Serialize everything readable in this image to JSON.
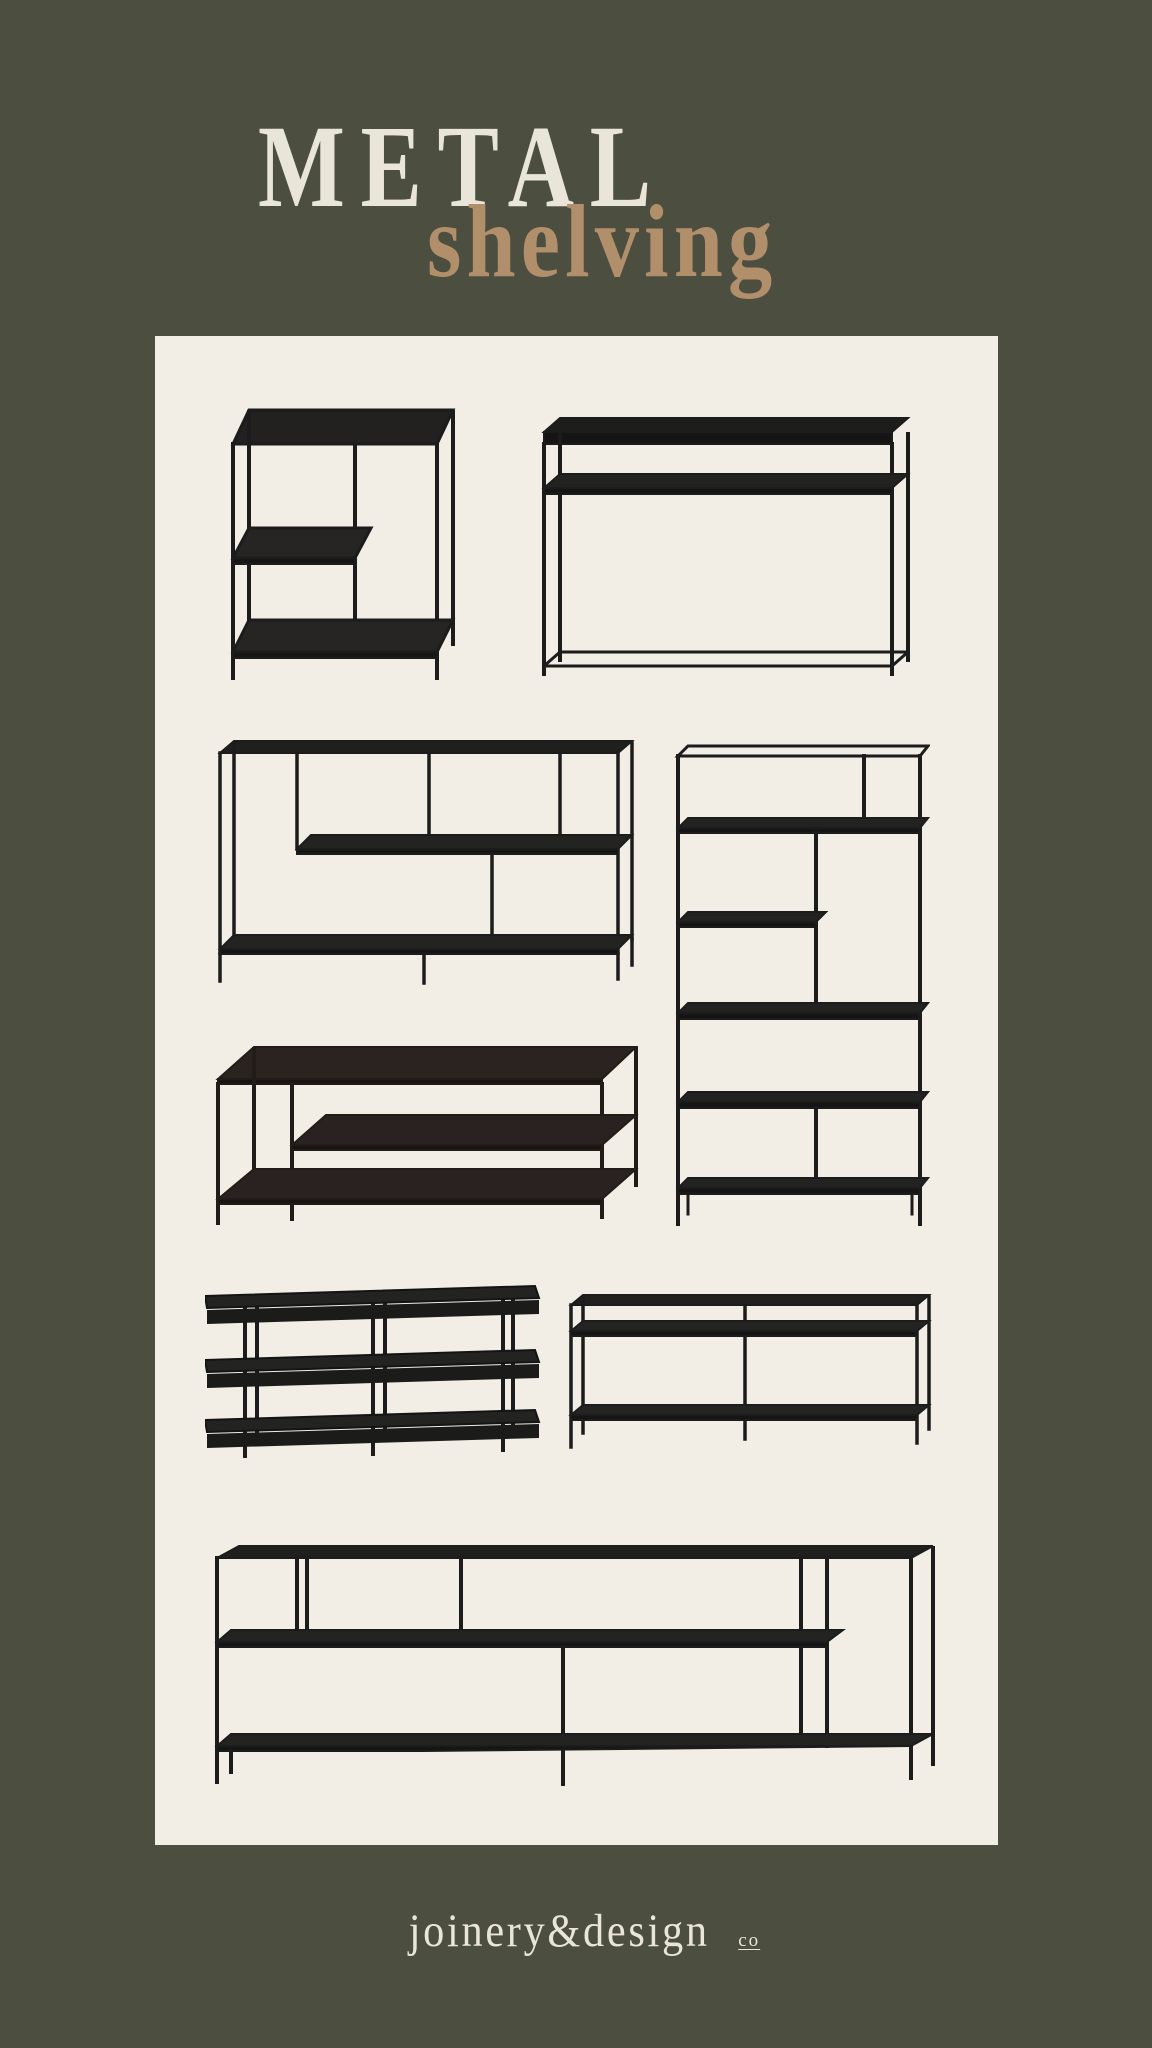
{
  "theme": {
    "background_color": "#4c4e40",
    "panel_color": "#f2ede5",
    "title_color": "#e9e5d8",
    "subtitle_color": "#b18f6b",
    "furniture_color": "#1c1c1c"
  },
  "header": {
    "title": "METAL",
    "subtitle": "shelving"
  },
  "gallery": {
    "items": [
      {
        "id": "offset-shelf-side-table",
        "description": "black metal side table with offset left shelf and full bottom shelf"
      },
      {
        "id": "slim-console-table",
        "description": "black metal console table with under-top shelf and base stretcher"
      },
      {
        "id": "low-staggered-bookcase",
        "description": "wide low bookcase with staggered shelves and asymmetric dividers"
      },
      {
        "id": "tall-staggered-etagere",
        "description": "tall bookcase etagere with five staggered shelves"
      },
      {
        "id": "two-tier-coffee-table",
        "description": "rectangular coffee table with offset middle shelf and bottom shelf"
      },
      {
        "id": "three-tier-open-shelf",
        "description": "three tier open shelf console on slim rod legs"
      },
      {
        "id": "divided-console-table",
        "description": "console table with under-top shelf, center divider and bottom shelf"
      },
      {
        "id": "long-media-console",
        "description": "long media console with staggered shelves and vertical dividers"
      }
    ]
  },
  "footer": {
    "brand": "joinery&design",
    "brand_suffix": "co"
  }
}
